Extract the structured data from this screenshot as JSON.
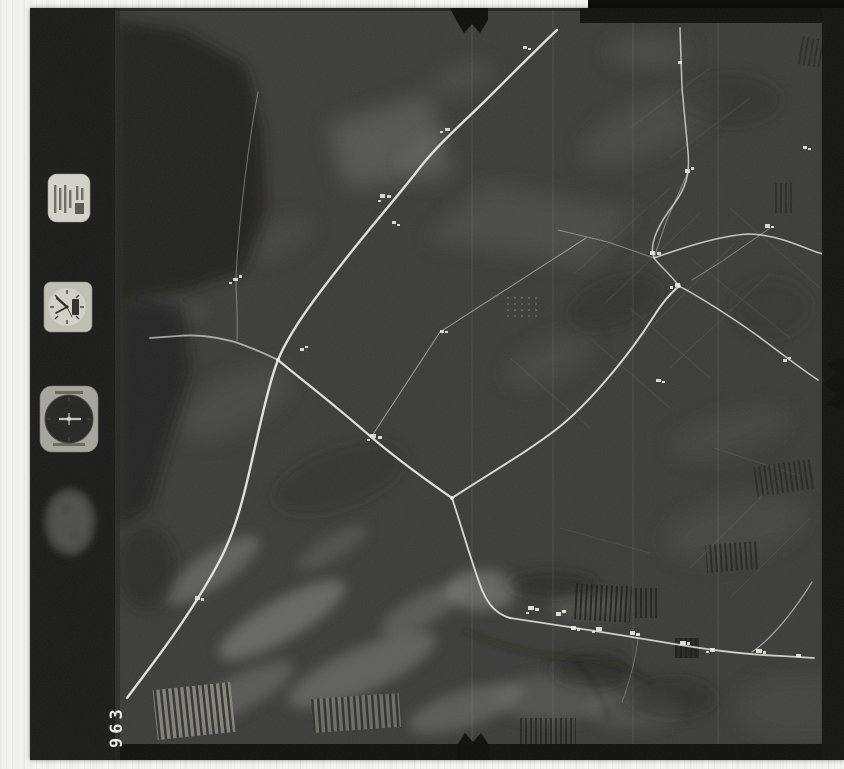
{
  "scan": {
    "frame_number": "963",
    "film_strip": {
      "instruments": [
        {
          "name": "data-plate-icon"
        },
        {
          "name": "clock-icon"
        },
        {
          "name": "altimeter-icon"
        },
        {
          "name": "level-bubble-icon"
        }
      ]
    },
    "colors": {
      "scan_margin": "#f2f2ef",
      "photo_base": "#3b3b39",
      "film_strip": "#191917",
      "road": "#ebebe5",
      "edge_band": "#0f0f0e",
      "instrument_plate": "#c9c9c1"
    }
  }
}
